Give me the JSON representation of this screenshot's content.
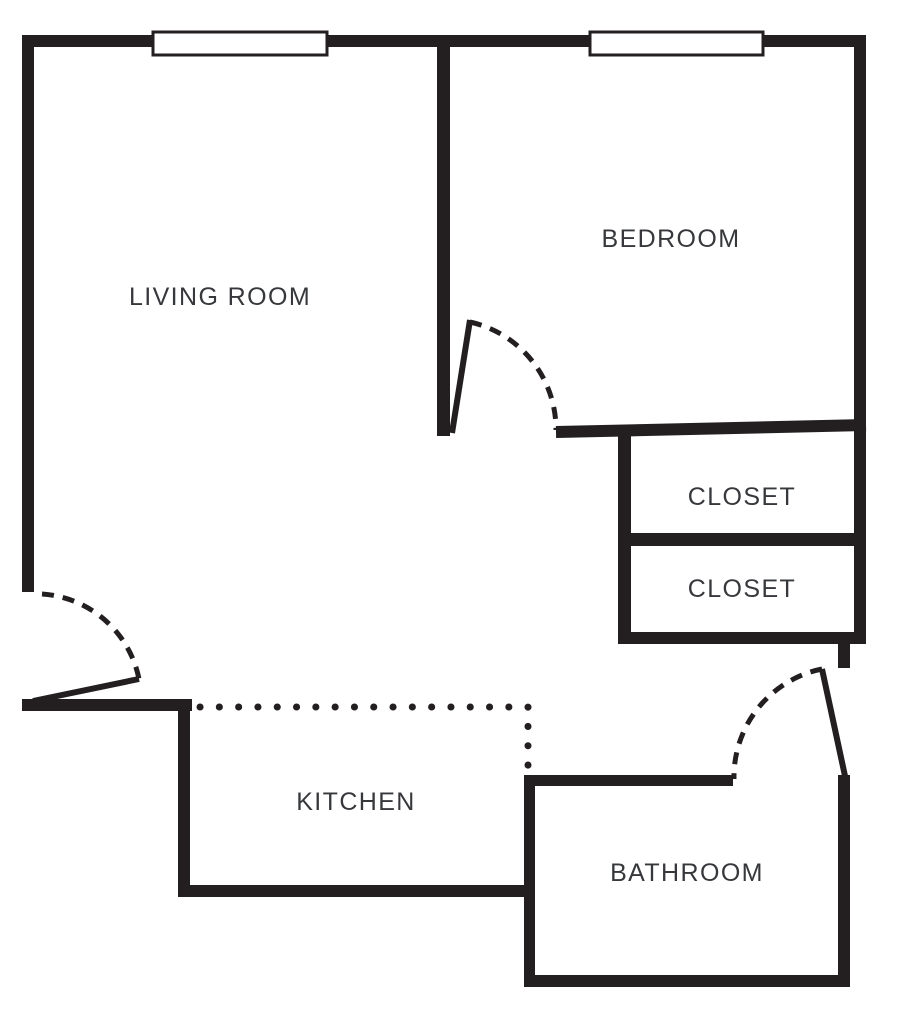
{
  "document": {
    "type": "floor-plan",
    "title": "Apartment floor plan"
  },
  "colors": {
    "wall": "#231f20",
    "background": "#ffffff",
    "text": "#36383b",
    "window_fill": "#ffffff"
  },
  "rooms": {
    "living_room": {
      "label": "LIVING ROOM"
    },
    "bedroom": {
      "label": "BEDROOM"
    },
    "closet_upper": {
      "label": "CLOSET"
    },
    "closet_lower": {
      "label": "CLOSET"
    },
    "kitchen": {
      "label": "KITCHEN"
    },
    "bathroom": {
      "label": "BATHROOM"
    }
  }
}
